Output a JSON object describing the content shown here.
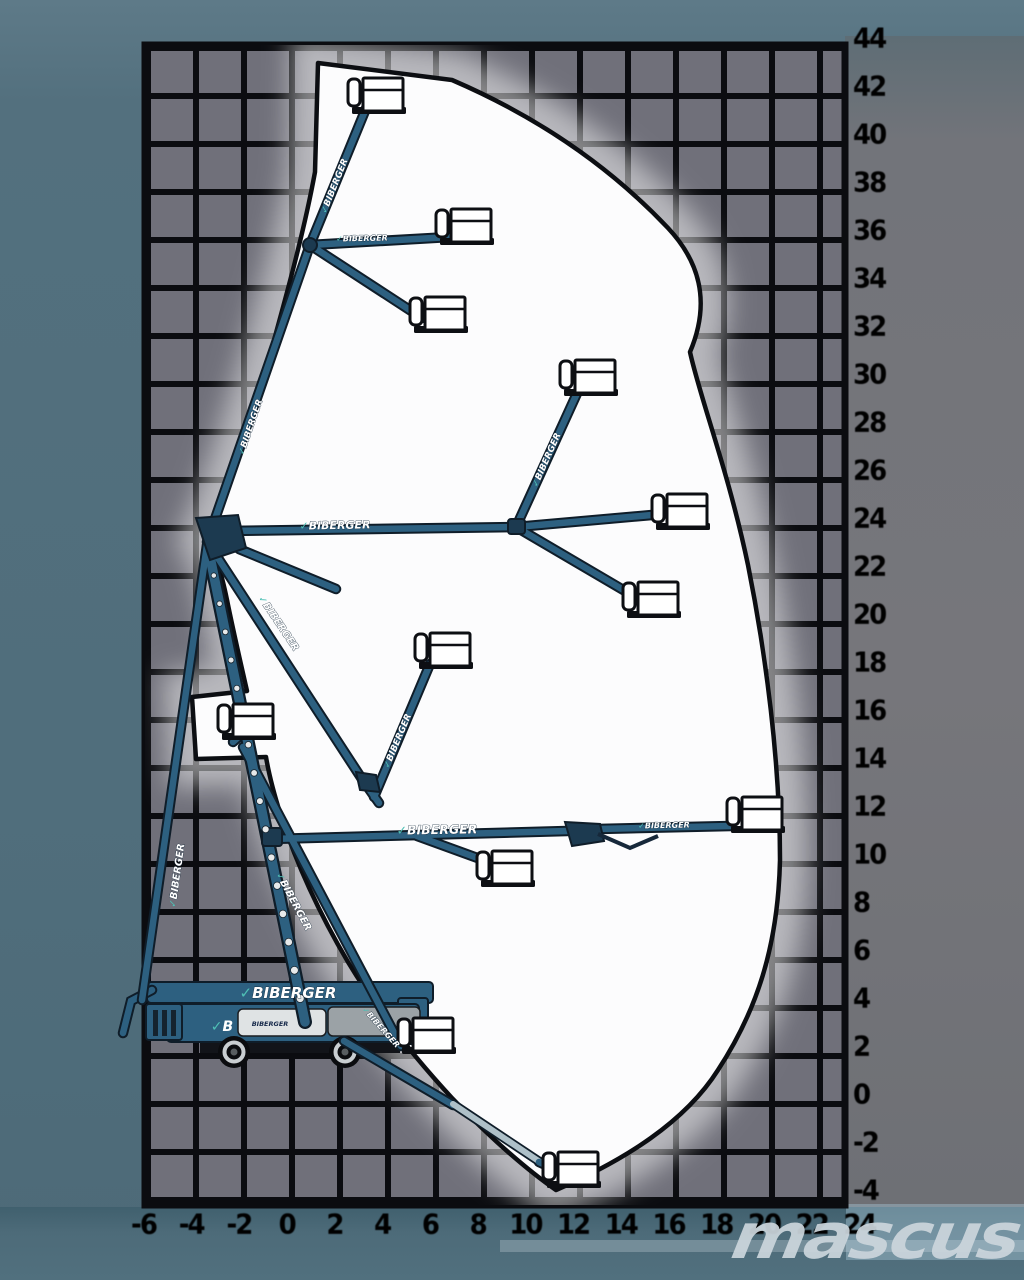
{
  "diagram": {
    "title": "boom-lift-working-envelope",
    "brand": "BIBERGER",
    "machine_body_logo": "B",
    "watermark": "mascus",
    "icons": {
      "swoosh": "✓"
    },
    "right_axis": {
      "values": [
        44,
        42,
        40,
        38,
        36,
        34,
        32,
        30,
        28,
        26,
        24,
        22,
        20,
        18,
        16,
        14,
        12,
        10,
        8,
        6,
        4,
        2,
        0,
        -2,
        -4
      ]
    },
    "bottom_axis": {
      "values": [
        -6,
        -4,
        -2,
        0,
        2,
        4,
        6,
        8,
        10,
        12,
        14,
        16,
        18,
        20,
        22,
        24
      ]
    },
    "colors": {
      "background_teal": "#51707e",
      "grid_cell": "#70707a",
      "grid_line": "#0b0c10",
      "envelope_white": "#fcfcfd",
      "boom_blue": "#2d6080",
      "axis_label": "#0b0b10",
      "watermark_gray": "#cbd5dc",
      "accent_teal": "#4fc0b5"
    }
  }
}
